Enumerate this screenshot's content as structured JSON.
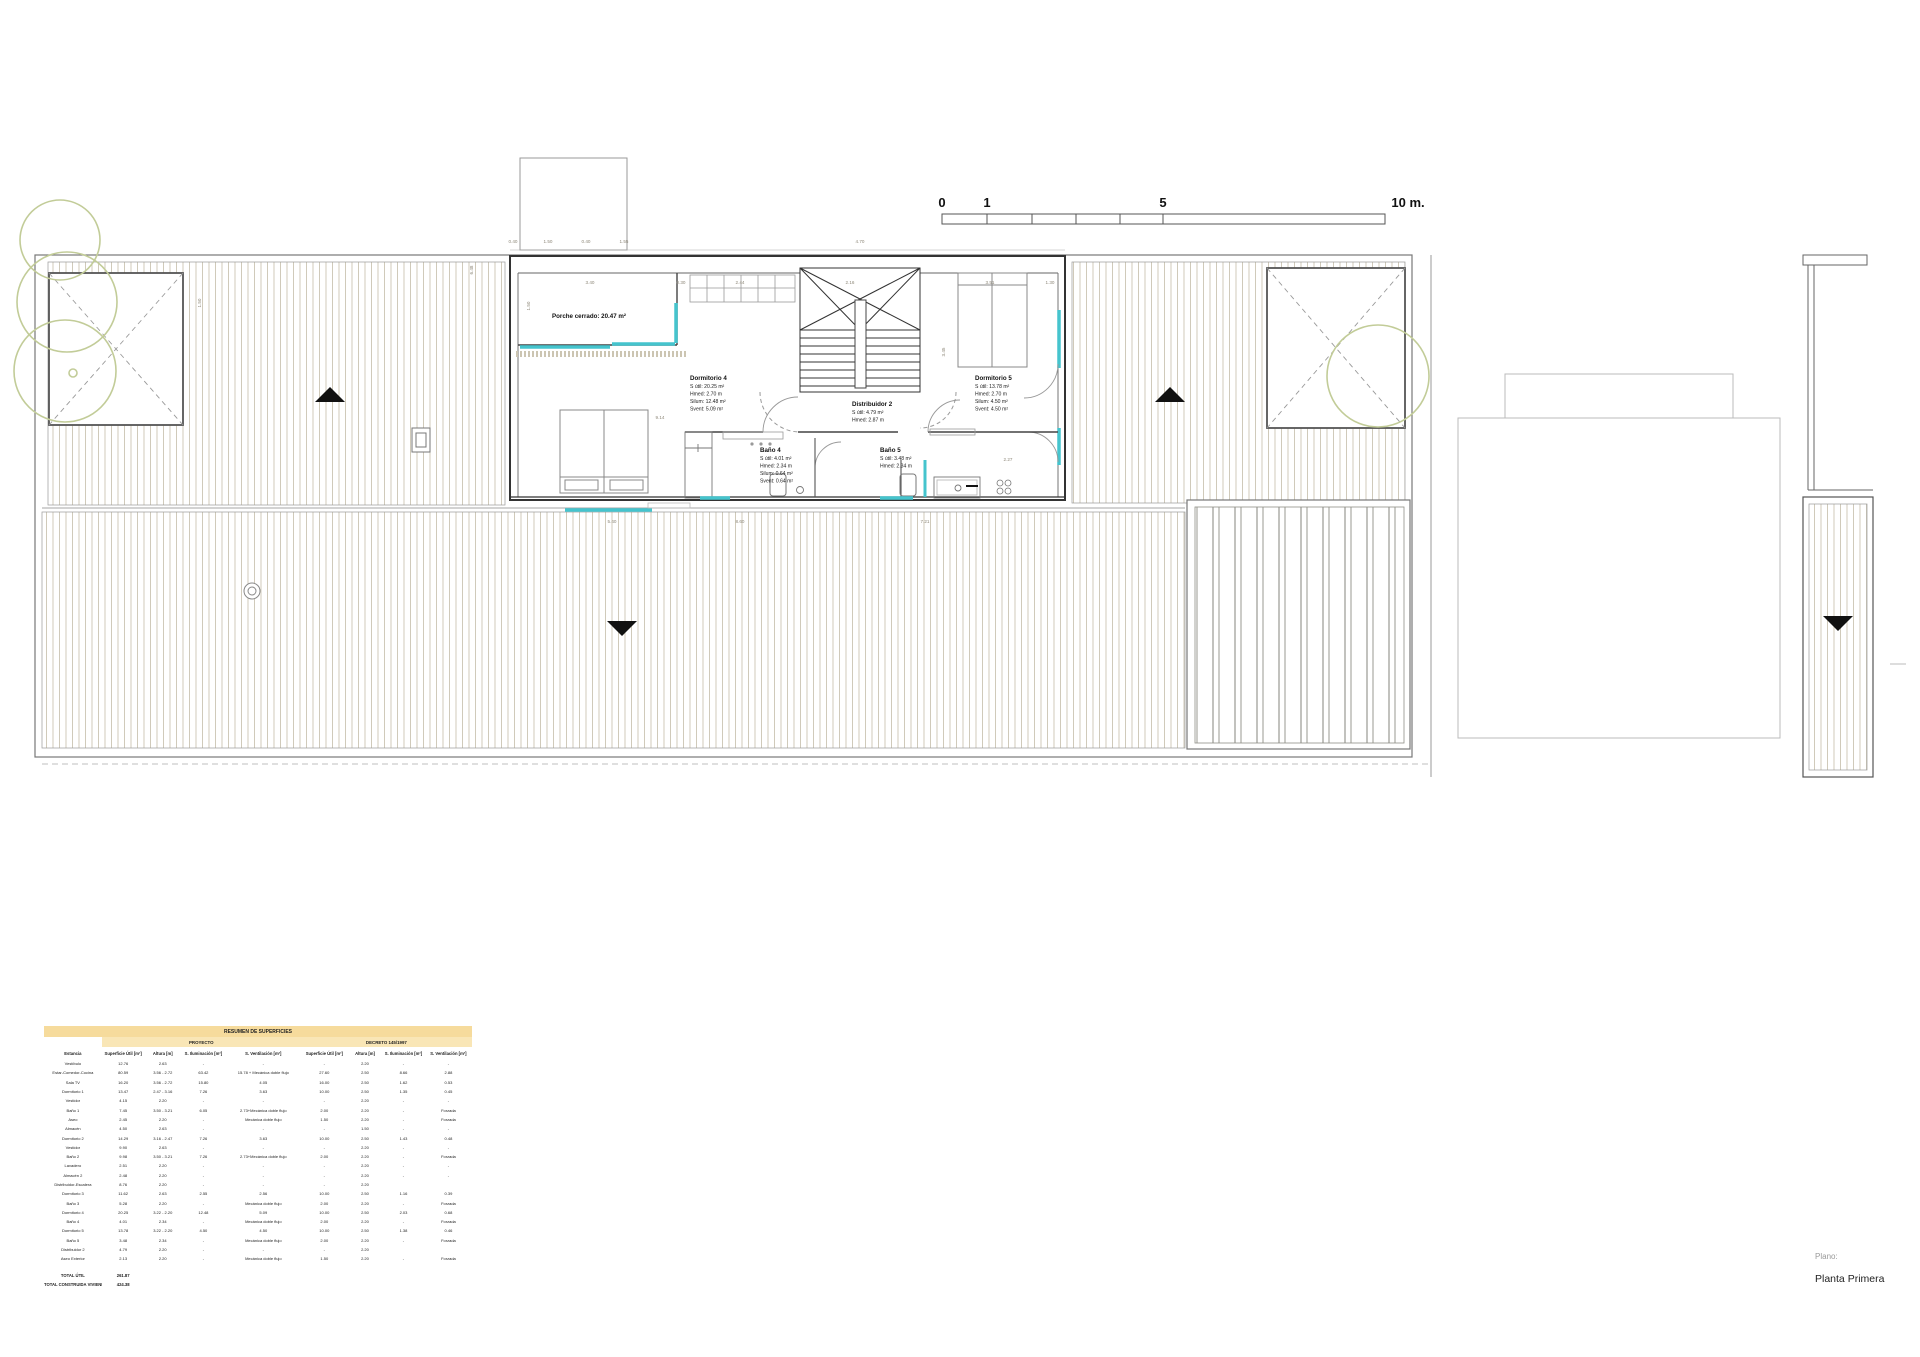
{
  "page": {
    "title_label": "Plano:",
    "title_value": "Planta Primera"
  },
  "scale_bar": {
    "unit_labels": [
      {
        "t": "0",
        "x": 942
      },
      {
        "t": "1",
        "x": 987
      },
      {
        "t": "5",
        "x": 1163
      },
      {
        "t": "10 m.",
        "x": 1408
      }
    ]
  },
  "plan": {
    "rooms": [
      {
        "id": "porche-cerrado",
        "x": 552,
        "y": 318,
        "name": "Porche cerrado: 20.47 m²",
        "lines": []
      },
      {
        "id": "dormitorio-4",
        "x": 690,
        "y": 380,
        "name": "Dormitorio 4",
        "lines": [
          "S útil: 20.25 m²",
          "Hmed: 2.70 m",
          "Silum: 12.48 m²",
          "Svent: 5.09 m²"
        ]
      },
      {
        "id": "distribuidor-2",
        "x": 852,
        "y": 406,
        "name": "Distribuidor 2",
        "lines": [
          "S útil: 4.79 m²",
          "Hmed: 2.87 m"
        ]
      },
      {
        "id": "dormitorio-5",
        "x": 975,
        "y": 380,
        "name": "Dormitorio 5",
        "lines": [
          "S útil: 13.78 m²",
          "Hmed: 2.70 m",
          "Silum: 4.50 m²",
          "Svent: 4.50 m²"
        ]
      },
      {
        "id": "bano-4",
        "x": 760,
        "y": 452,
        "name": "Baño 4",
        "lines": [
          "S útil: 4.01 m²",
          "Hmed: 2.34 m",
          "Silum: 0.64 m²",
          "Svent: 0.64 m²"
        ]
      },
      {
        "id": "bano-5",
        "x": 880,
        "y": 452,
        "name": "Baño 5",
        "lines": [
          "S útil: 3.48 m²",
          "Hmed: 2.34 m"
        ]
      }
    ],
    "dimensions": [
      {
        "t": "0.40",
        "x": 513,
        "y": 243
      },
      {
        "t": "1.50",
        "x": 548,
        "y": 243
      },
      {
        "t": "0.40",
        "x": 586,
        "y": 243
      },
      {
        "t": "1.55",
        "x": 624,
        "y": 243
      },
      {
        "t": "4.70",
        "x": 860,
        "y": 243
      },
      {
        "t": "3.40",
        "x": 590,
        "y": 284
      },
      {
        "t": "0.30",
        "x": 681,
        "y": 284
      },
      {
        "t": "2.44",
        "x": 740,
        "y": 284
      },
      {
        "t": "2.16",
        "x": 850,
        "y": 284
      },
      {
        "t": "3.51",
        "x": 990,
        "y": 284
      },
      {
        "t": "1.30",
        "x": 1050,
        "y": 284
      },
      {
        "t": "9.14",
        "x": 660,
        "y": 419
      },
      {
        "t": "2.27",
        "x": 1008,
        "y": 461
      },
      {
        "t": "5.40",
        "x": 612,
        "y": 523
      },
      {
        "t": "8.60",
        "x": 740,
        "y": 523
      },
      {
        "t": "7.21",
        "x": 925,
        "y": 523
      },
      {
        "t": "6.48",
        "x": 473,
        "y": 270,
        "r": -90
      },
      {
        "t": "1.50",
        "x": 530,
        "y": 306,
        "r": -90
      },
      {
        "t": "3.45",
        "x": 945,
        "y": 352,
        "r": -90
      },
      {
        "t": "1.50",
        "x": 201,
        "y": 303,
        "r": -90
      }
    ]
  },
  "table": {
    "title": "RESUMEN DE SUPERFICIES",
    "project_header": "PROYECTO",
    "decreto_header": "DECRETO 145/1997",
    "columns": [
      "Estancia",
      "Superficie Útil [m²]",
      "Altura [m]",
      "S. Iluminación  [m²]",
      "S. Ventilación [m²]",
      "Superficie Útil [m²]",
      "Altura [m]",
      "S. Iluminación  [m²]",
      "S. Ventilación [m²]"
    ],
    "rows": [
      [
        "Vestíbulo",
        "12.76",
        "2.63",
        "-",
        "-",
        "-",
        "2.20",
        "-",
        "-"
      ],
      [
        "Estar-Comedor-Cocina",
        "80.59",
        "3.56 - 2.72",
        "63.42",
        "15.78 + Mecánica doble flujo",
        "27.60",
        "2.50",
        "8.66",
        "2.88"
      ],
      [
        "Sala TV",
        "16.20",
        "3.56 - 2.72",
        "15.80",
        "4.05",
        "16.00",
        "2.50",
        "1.62",
        "0.53"
      ],
      [
        "Dormitorio 1",
        "13.47",
        "2.47 - 3.16",
        "7.26",
        "3.63",
        "10.00",
        "2.50",
        "1.35",
        "0.45"
      ],
      [
        "Vestidor",
        "4.15",
        "2.20",
        "-",
        "-",
        "-",
        "2.20",
        "-",
        "-"
      ],
      [
        "Baño 1",
        "7.45",
        "3.50 - 3.21",
        "6.05",
        "2.73+Mecánica doble flujo",
        "2.00",
        "2.20",
        "-",
        "Forzada"
      ],
      [
        "Aseo",
        "2.45",
        "2.20",
        "-",
        "Mecánica doble flujo",
        "1.50",
        "2.20",
        "-",
        "Forzada"
      ],
      [
        "Almacén",
        "4.50",
        "2.63",
        "-",
        "-",
        "-",
        "1.50",
        "-",
        "-"
      ],
      [
        "Dormitorio 2",
        "14.29",
        "3.16 - 2.47",
        "7.26",
        "3.63",
        "10.00",
        "2.50",
        "1.43",
        "0.48"
      ],
      [
        "Vestidor",
        "9.90",
        "2.63",
        "-",
        "-",
        "-",
        "2.20",
        "-",
        "-"
      ],
      [
        "Baño 2",
        "9.98",
        "3.50 - 3.21",
        "7.26",
        "2.73+Mecánica doble flujo",
        "2.00",
        "2.20",
        "-",
        "Forzada"
      ],
      [
        "Lavadero",
        "2.51",
        "2.20",
        "-",
        "-",
        "-",
        "2.20",
        "-",
        "-"
      ],
      [
        "Almacén 2",
        "2.48",
        "2.20",
        "-",
        "-",
        "-",
        "2.20",
        "-",
        "-"
      ],
      [
        "Distribuidor-Escalera",
        "8.76",
        "2.20",
        "-",
        "-",
        "-",
        "2.20",
        "",
        ""
      ],
      [
        "Dormitorio 3",
        "11.62",
        "2.63",
        "2.55",
        "2.56",
        "10.00",
        "2.50",
        "1.16",
        "0.39"
      ],
      [
        "Baño 3",
        "5.28",
        "2.20",
        "-",
        "Mecánica doble flujo",
        "2.00",
        "2.20",
        "-",
        "Forzada"
      ],
      [
        "Dormitorio 4",
        "20.25",
        "3.22 - 2.20",
        "12.48",
        "5.09",
        "10.00",
        "2.50",
        "2.03",
        "0.68"
      ],
      [
        "Baño 4",
        "4.01",
        "2.34",
        "-",
        "Mecánica doble flujo",
        "2.00",
        "2.20",
        "-",
        "Forzada"
      ],
      [
        "Dormitorio 5",
        "13.78",
        "3.22 - 2.20",
        "4.50",
        "4.50",
        "10.00",
        "2.50",
        "1.38",
        "0.46"
      ],
      [
        "Baño 5",
        "3.48",
        "2.34",
        "-",
        "Mecánica doble flujo",
        "2.00",
        "2.20",
        "-",
        "Forzada"
      ],
      [
        "Distribuidor 2",
        "4.79",
        "2.20",
        "-",
        "-",
        "-",
        "2.20",
        "",
        ""
      ],
      [
        "Aseo Exterior",
        "2.13",
        "2.20",
        "-",
        "Mecánica doble flujo",
        "1.50",
        "2.20",
        "-",
        "Forzada"
      ]
    ],
    "totals": [
      {
        "label": "TOTAL ÚTIL",
        "value": "261.87"
      },
      {
        "label": "TOTAL CONSTRUIDA VIVIENDA",
        "value": "424.38"
      }
    ]
  },
  "colors": {
    "accent_window": "#45c4cd",
    "hatch": "#cbc5b3",
    "tree": "#c2cc98",
    "table_header": "#f6db9c"
  }
}
